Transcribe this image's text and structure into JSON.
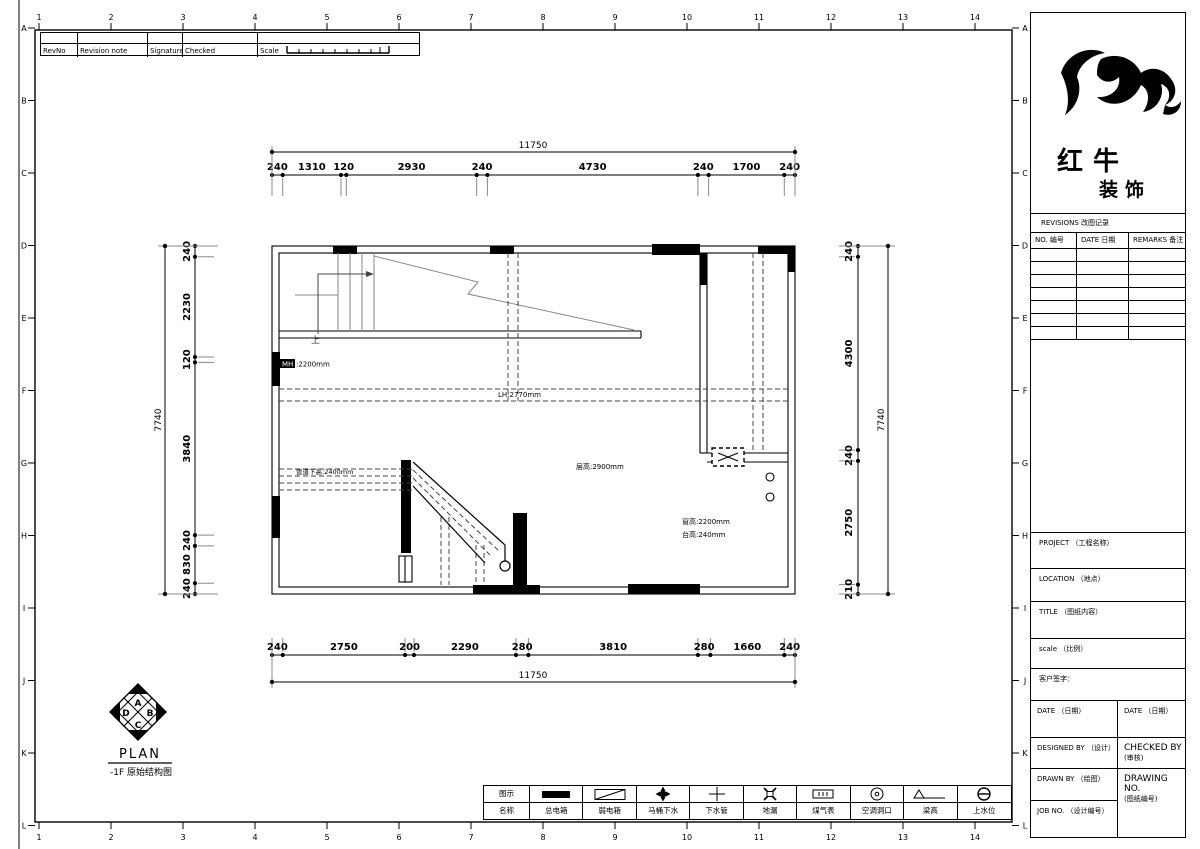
{
  "sheet": {
    "grid_numbers": [
      "1",
      "2",
      "3",
      "4",
      "5",
      "6",
      "7",
      "8",
      "9",
      "10",
      "11",
      "12",
      "13",
      "14"
    ],
    "grid_letters": [
      "A",
      "B",
      "C",
      "D",
      "E",
      "F",
      "G",
      "H",
      "I",
      "J",
      "K",
      "L"
    ],
    "revision_strip": {
      "rev_no": "RevNo",
      "revision_note": "Revision note",
      "signature": "Signature",
      "checked": "Checked",
      "scale": "Scale"
    }
  },
  "title_block": {
    "brand_top": "红牛",
    "brand_bottom": "装饰",
    "logo_icon": "bull-swoosh-logo",
    "revisions_title": "REVISIONS 改图记录",
    "revisions_columns": [
      "NO. 编号",
      "DATE 日期",
      "REMARKS 备注"
    ],
    "project": "PROJECT （工程名称）",
    "location": "LOCATION （地点）",
    "title": "TITLE （图纸内容）",
    "scale": "scale （比例）",
    "client_sign": "客户签字：",
    "date_left": "DATE （日期）",
    "date_right": "DATE （日期）",
    "designed_by": "DESIGNED BY （设计）",
    "checked_by_1": "CHECKED BY",
    "checked_by_2": "(审核)",
    "drawn_by": "DRAWN BY （绘图）",
    "drawing_no_1": "DRAWING NO.",
    "drawing_no_2": "(图纸编号)",
    "job_no": "JOB NO. （设计编号）"
  },
  "plan": {
    "name": "PLAN",
    "subtitle": "-1F 原始结构图",
    "compass": [
      "A",
      "B",
      "C",
      "D"
    ],
    "labels": {
      "mh_prefix": "MH",
      "mh_value": ":2200mm",
      "lh": "LH:2770mm",
      "storey_height": "层高:2900mm",
      "pipe_clearance": "管道下高:2400mm",
      "window_height": "窗高:2200mm",
      "sill_height": "台高:240mm",
      "stair_up": "上"
    },
    "dimensions": {
      "top": {
        "overall": "11750",
        "segments": [
          "240",
          "1310",
          "120",
          "2930",
          "240",
          "4730",
          "240",
          "1700",
          "240"
        ]
      },
      "bottom": {
        "overall": "11750",
        "segments": [
          "240",
          "2750",
          "200",
          "2290",
          "280",
          "3810",
          "280",
          "1660",
          "240"
        ]
      },
      "left": {
        "overall": "7740",
        "segments": [
          "240",
          "2230",
          "120",
          "3840",
          "240",
          "830",
          "240"
        ]
      },
      "right": {
        "overall": "7740",
        "segments": [
          "240",
          "4300",
          "240",
          "2750",
          "210"
        ]
      }
    }
  },
  "legend": {
    "row1_label": "图示",
    "row2_label": "名称",
    "items": [
      {
        "name": "总电箱",
        "icon": "main-power-box-icon"
      },
      {
        "name": "弱电箱",
        "icon": "low-voltage-box-icon"
      },
      {
        "name": "马桶下水",
        "icon": "toilet-drain-icon"
      },
      {
        "name": "下水管",
        "icon": "drain-pipe-icon"
      },
      {
        "name": "地漏",
        "icon": "floor-drain-icon"
      },
      {
        "name": "煤气表",
        "icon": "gas-meter-icon"
      },
      {
        "name": "空调洞口",
        "icon": "ac-opening-icon"
      },
      {
        "name": "梁高",
        "icon": "beam-height-icon"
      },
      {
        "name": "上水位",
        "icon": "water-supply-icon"
      }
    ]
  }
}
